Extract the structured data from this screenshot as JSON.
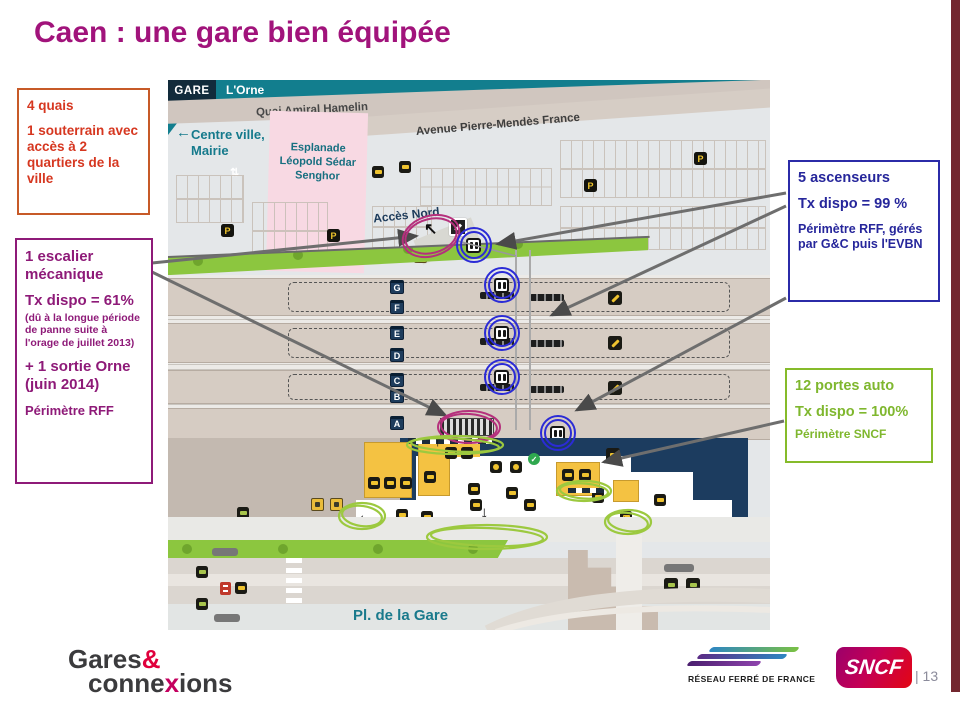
{
  "slide": {
    "title": "Caen :  une gare bien équipée",
    "page_number": "| 13"
  },
  "callouts": {
    "quais": {
      "line1": "4 quais",
      "line2": "1 souterrain avec accès à 2 quartiers de la ville"
    },
    "escalier": {
      "line1": "1 escalier mécanique",
      "line2": "Tx dispo = 61%",
      "note": "(dû à la longue période de panne suite à l'orage de juillet 2013)",
      "line3": "+ 1 sortie Orne (juin 2014)",
      "line4": "Périmètre RFF"
    },
    "ascenseurs": {
      "line1": "5 ascenseurs",
      "line2": "Tx dispo = 99 %",
      "note": "Périmètre RFF, gérés par G&C puis l'EVBN"
    },
    "portes": {
      "line1": "12 portes auto",
      "line2": "Tx dispo = 100%",
      "note": "Périmètre SNCF"
    }
  },
  "map": {
    "labels": {
      "gare": "GARE",
      "river": "L'Orne",
      "quai": "Quai Amiral Hamelin",
      "centre_ville": "Centre ville, Mairie",
      "esplanade": "Esplanade Léopold Sédar Senghor",
      "avenue": "Avenue Pierre-Mendès France",
      "acces_nord": "Accès Nord",
      "place": "Pl. de la Gare",
      "gare_routiere": "Gare routière"
    },
    "platforms": [
      "G",
      "F",
      "E",
      "D",
      "C",
      "B",
      "A"
    ],
    "parking_label": "P"
  },
  "icons": {
    "left_arrow": "←",
    "up_arrow": "↑",
    "down_arrow": "↓",
    "up_left_arrow": "↖",
    "up_down_arrow": "⇅"
  },
  "footer": {
    "gares_connexions": {
      "word1": "Gares",
      "amp": "&",
      "word2_start": "conne",
      "word2_x": "x",
      "word2_end": "ions"
    },
    "rff": "RÉSEAU FERRÉ DE FRANCE",
    "sncf": "SNCF"
  },
  "colors": {
    "title": "#A1137B",
    "red_callout": "#D63720",
    "purple_callout": "#8E1A78",
    "blue_callout": "#26269B",
    "green_callout": "#7FB72E",
    "map_teal": "#157A8C",
    "map_navy": "#1C3C5F",
    "highlight_pink": "#B5307C",
    "highlight_blue": "#2B2BD6",
    "highlight_green": "#9CC93F",
    "side_bar": "#73272F"
  }
}
